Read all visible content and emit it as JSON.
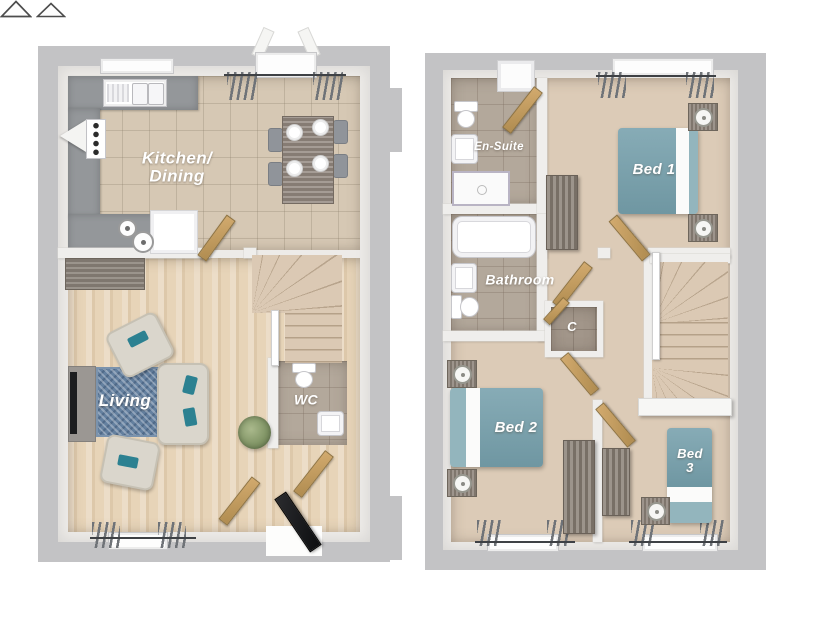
{
  "figure": {
    "type": "floor-plan",
    "views": [
      "ground-floor",
      "first-floor"
    ]
  },
  "palette": {
    "wall_outer": "#c3c3c5",
    "wall_inner": "#edebe8",
    "carpet": "#dccbb7",
    "tile_kitchen": "#d6c8b4",
    "tile_bathroom": "#b3a89b",
    "tile_cupboard": "#a2968a",
    "wood_floor": "#e7d4b8",
    "counter_grey": "#94979a",
    "bed_teal": "#76a0ac",
    "cushion_teal": "#2c8191",
    "rug_blue": "#64809f",
    "door_wood": "#c29c60",
    "front_door_black": "#17181a",
    "furniture_wood": "#8a8076",
    "label_text": "#ffffff"
  },
  "ground_floor": {
    "labels": {
      "kitchen_dining_line1": "Kitchen/",
      "kitchen_dining_line2": "Dining",
      "living": "Living",
      "wc": "WC"
    }
  },
  "first_floor": {
    "labels": {
      "ensuite": "En-Suite",
      "bed1": "Bed 1",
      "bathroom": "Bathroom",
      "cupboard": "C",
      "bed2": "Bed 2",
      "bed3_line1": "Bed",
      "bed3_line2": "3"
    }
  }
}
